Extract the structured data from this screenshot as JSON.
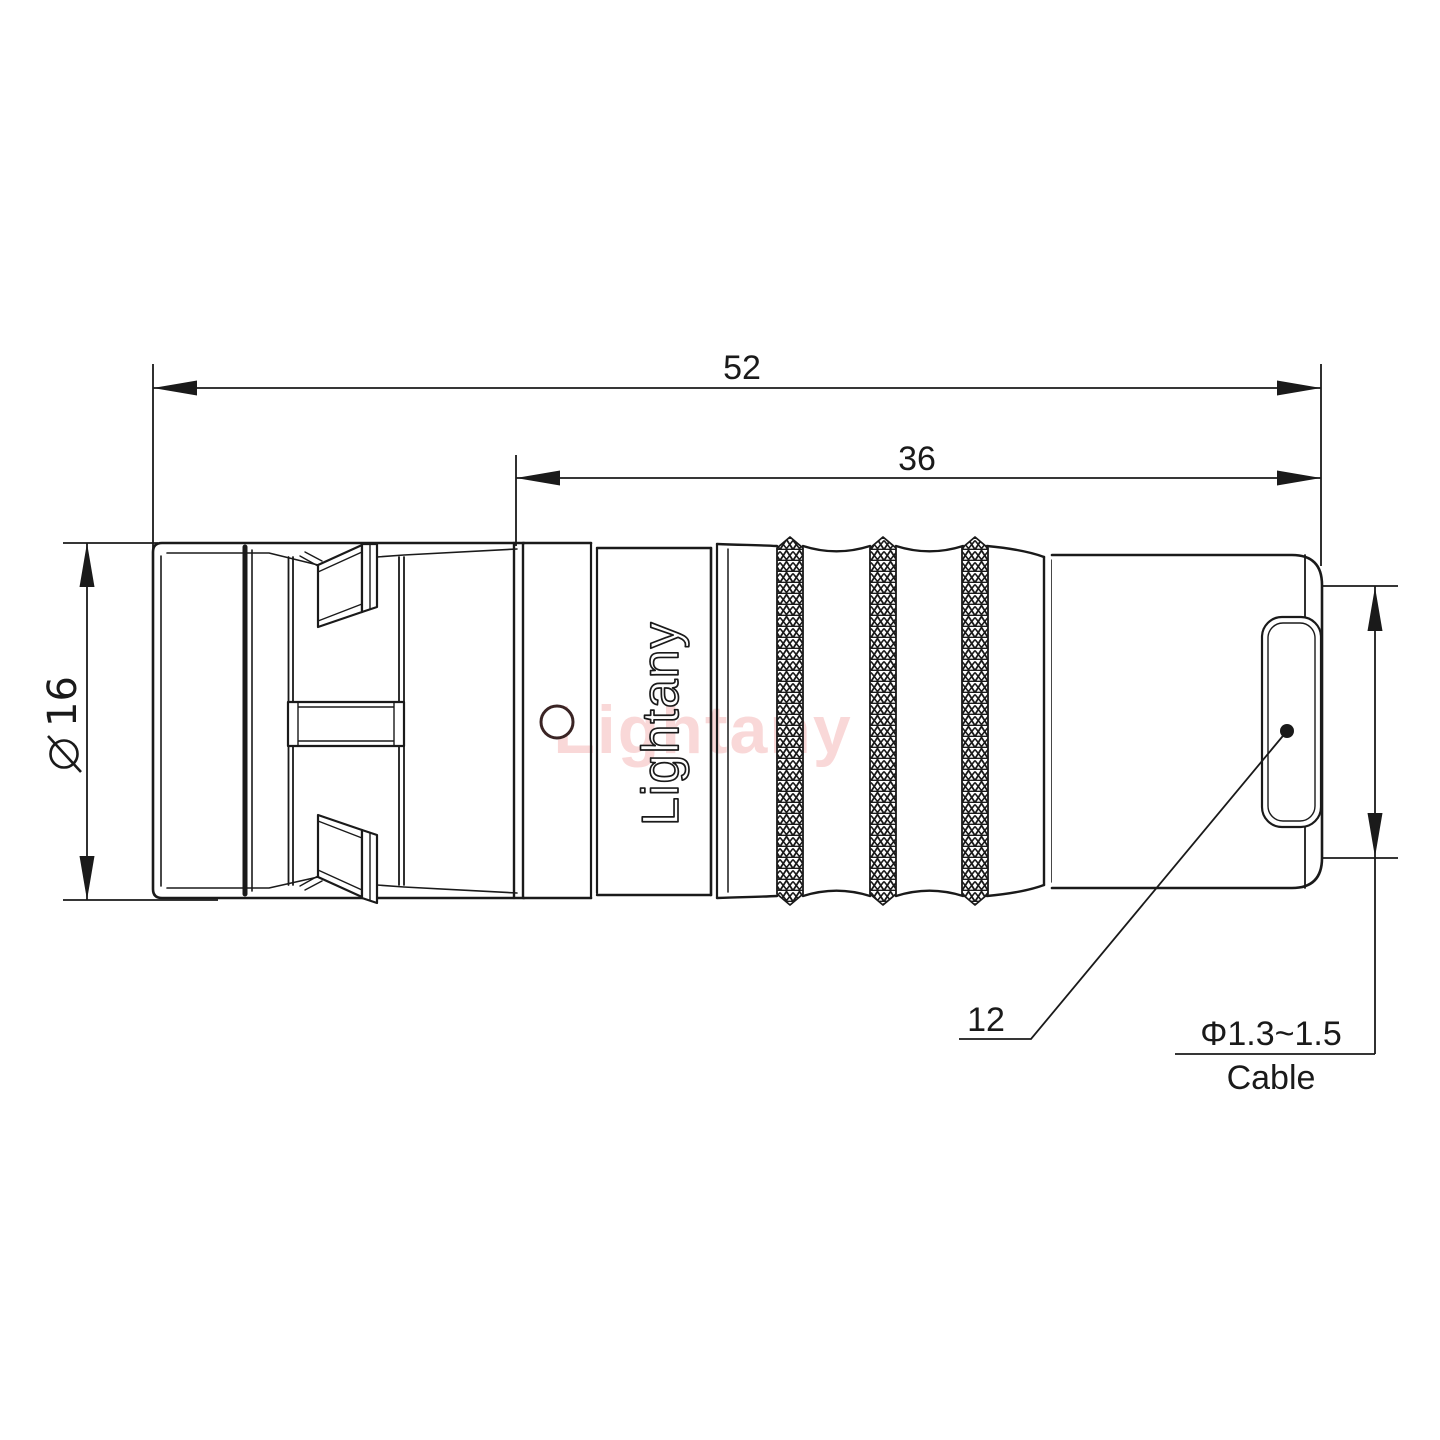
{
  "drawing": {
    "watermark": "Lightany",
    "engraving": "Lightany",
    "dims": {
      "overall_length": "52",
      "mid_length": "36",
      "front_diameter_value": "16",
      "rear_ref": "12",
      "cable_range": "Φ1.3~1.5",
      "cable_word": "Cable"
    },
    "colors": {
      "line": "#1a1a1a",
      "watermark_pink": "#f2a9a9",
      "hole_ring": "#3a2424",
      "background": "#ffffff"
    }
  }
}
